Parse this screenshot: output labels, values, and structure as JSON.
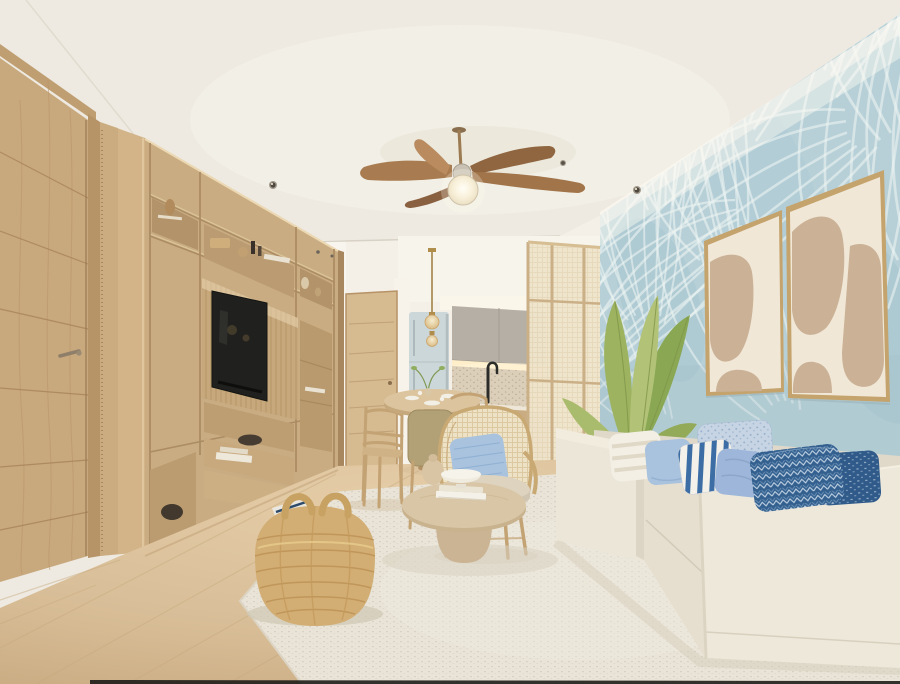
{
  "scene": {
    "type": "interior-3d-render",
    "room": "coastal-living-room",
    "objects": [
      "ceiling-fan-with-light",
      "recessed-ceiling-lights",
      "wood-entry-door",
      "wardrobe-panel",
      "media-wall-unit",
      "tv-screen",
      "shelf-decor-objects",
      "hallway",
      "interior-wood-door",
      "kitchen-upper-cabinets",
      "refrigerator",
      "terrazzo-backsplash",
      "black-faucet",
      "kitchen-lower-cabinets",
      "glass-pendant-light",
      "round-dining-table",
      "dining-chairs",
      "rattan-armchair",
      "blue-throw-pillow",
      "cane-room-divider",
      "leaning-mirror",
      "console-table",
      "table-lamp",
      "palm-leaf-wallpaper-wall",
      "abstract-art-frame-left",
      "abstract-art-frame-right",
      "banana-leaf-plant",
      "cream-sofa",
      "blue-pillow-set",
      "round-coffee-table",
      "book-stack",
      "white-bowl",
      "gourd-vase",
      "woven-storage-basket",
      "textured-area-rug",
      "light-wood-floor"
    ]
  },
  "colors": {
    "ceiling": "#eeeae1",
    "wall": "#f4f0e8",
    "wallpaper": "#b7d0d8",
    "leafline": "#edf4f2",
    "wood": "#c9ac82",
    "wood_light": "#d6ba90",
    "wood_dark": "#ab8a60",
    "floor": "#d9bf99",
    "rug": "#e9e4d7",
    "sofa": "#ece6d8",
    "sofa_shadow": "#d9d1c0",
    "pillow_blue": "#a9c3de",
    "pillow_navy": "#33608f",
    "pillow_chambray": "#c6d4e4",
    "frame_gold": "#c4a36d",
    "art_paper": "#f1e7d7",
    "art_blob": "#cbb296",
    "tv": "#20211e",
    "kitchen_gray": "#b5afa6",
    "plant": "#9db35f",
    "basket": "#d2ae74",
    "glow": "#fdf3da"
  }
}
